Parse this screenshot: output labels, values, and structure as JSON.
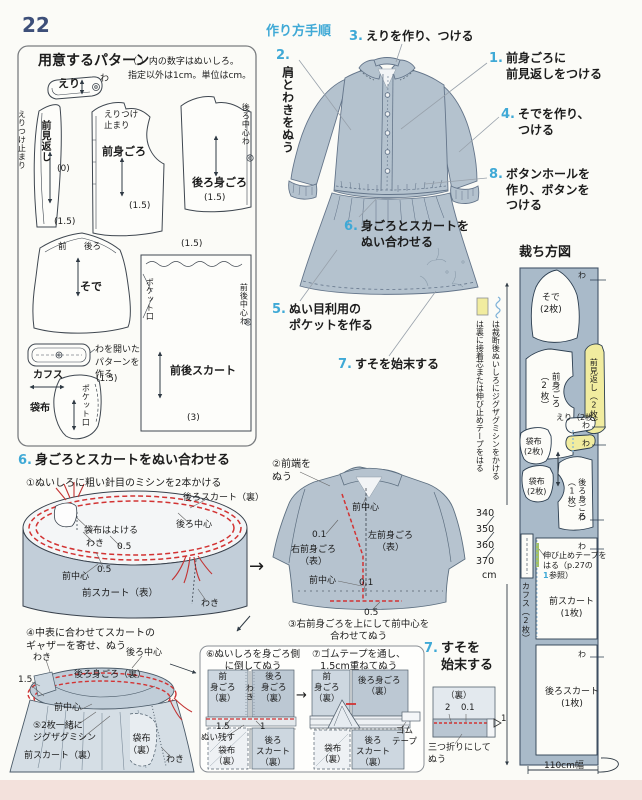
{
  "page": {
    "number": "22"
  },
  "arrows": {
    "right": "→"
  },
  "pattern_box": {
    "title": "用意するパターン",
    "note": "（ ）内の数字はぬいしろ。\n指定以外は1cm。単位はcm。",
    "collar": "えり",
    "wa": "わ",
    "collar_stop_v": "えりつけ止まり",
    "front_facing": "前見返し",
    "sa0": "(0)",
    "sa15": "(1.5)",
    "collar_stop": "えりつけ\n止まり",
    "front_bodice": "前身ごろ",
    "back_center_wa": "後ろ中心わ",
    "back_bodice": "後ろ身ごろ",
    "front": "前",
    "back": "後ろ",
    "sleeve": "そで",
    "cuff": "カフス",
    "open_note": "わを開いた\nパターンを\n作る",
    "pocket_bag": "袋布",
    "pocket_opening": "ポケット口",
    "skirt": "前後スカート",
    "fb_center_wa": "前後中心わ",
    "sa3": "(3)"
  },
  "steps": {
    "header": "作り方手順",
    "s1n": "1.",
    "s1": "前身ごろに\n前見返しをつける",
    "s2n": "2.",
    "s2": "肩とわきをぬう",
    "s3n": "3.",
    "s3": "えりを作り、つける",
    "s4n": "4.",
    "s4": "そでを作り、\nつける",
    "s5n": "5.",
    "s5": "ぬい目利用の\nポケットを作る",
    "s6n": "6.",
    "s6": "身ごろとスカートを\nぬい合わせる",
    "s7n": "7.",
    "s7": "すそを始末する",
    "s8n": "8.",
    "s8": "ボタンホールを\n作り、ボタンを\nつける"
  },
  "legend": {
    "zigzag_note": "は裁断後ぬいしろにジグザグミシンをかける",
    "fusible_note": "は裏に接着芯または伸び止めテープをはる"
  },
  "cutting": {
    "title": "裁ち方図",
    "sleeve": "そで\n(2枚)",
    "front_bodice": "前身ごろ\n（2枚）",
    "front_facing": "前見返し（2枚）",
    "collar": "えり（2枚）",
    "wa": "わ",
    "pocket_bag": "袋布\n(2枚)",
    "back_bodice": "後ろ身ごろ\n（1枚）",
    "cuff": "カフス（2枚）",
    "tape1": "伸び止めテープを",
    "tape2": "はる（p.27の",
    "tape_ref": "1",
    "tape3": "参照）",
    "front_skirt": "前スカート\n(1枚)",
    "back_skirt": "後ろスカート\n(1枚)",
    "sizes": "340\n350\n360\n370",
    "unit": "cm",
    "width": "110cm幅"
  },
  "sec6": {
    "hn": "6.",
    "heading": "身ごろとスカートをぬい合わせる",
    "d1": {
      "caption": "①ぬいしろに粗い針目のミシンを2本かける",
      "back_skirt": "後ろスカート（裏）",
      "back_center": "後ろ中心",
      "keep_pocket": "袋布はよける",
      "waki": "わき",
      "v05": "0.5",
      "front_center": "前中心",
      "front_skirt": "前スカート（表）"
    },
    "d2": {
      "caption": "②前端を\nぬう",
      "front_center": "前中心",
      "v01": "0.1",
      "right_front": "右前身ごろ\n（表）",
      "left_front": "左前身ごろ\n（表）",
      "v05": "0.5",
      "caption3": "③右前身ごろを上にして前中心を\n合わせてぬう"
    },
    "d3": {
      "caption": "④中表に合わせてスカートの\nギャザーを寄せ、ぬう",
      "waki": "わき",
      "back_center": "後ろ中心",
      "v15": "1.5",
      "back_bodice": "後ろ身ごろ（裏）",
      "front_center": "前中心",
      "zigzag": "⑤2枚一緒に\nジグザグミシン",
      "pocket": "袋布\n（裏）",
      "front_skirt": "前スカート（裏）"
    },
    "d4": {
      "caption": "⑥ぬいしろを身ごろ側\nに倒してぬう",
      "front_bodice": "前\n身ごろ\n（裏）",
      "waki": "わき",
      "back_bodice": "後ろ\n身ごろ\n（裏）",
      "v15": "1.5",
      "leave": "ぬい残す",
      "v1": "1",
      "pocket": "袋布\n（裏）",
      "back_skirt": "後ろ\nスカート\n（裏）"
    },
    "d5": {
      "caption": "⑦ゴムテープを通し、\n1.5cm重ねてぬう",
      "front_bodice": "前\n身ごろ\n（裏）",
      "back_bodice": "後ろ身ごろ\n（裏）",
      "pocket": "袋布\n（裏）",
      "back_skirt": "後ろ\nスカート\n（裏）",
      "elastic": "ゴム\nテープ"
    }
  },
  "sec7": {
    "hn": "7.",
    "heading": "すそを\n始末する",
    "ura": "（裏）",
    "v2": "2",
    "v01": "0.1",
    "v1": "1",
    "note": "三つ折りにして\nぬう"
  }
}
